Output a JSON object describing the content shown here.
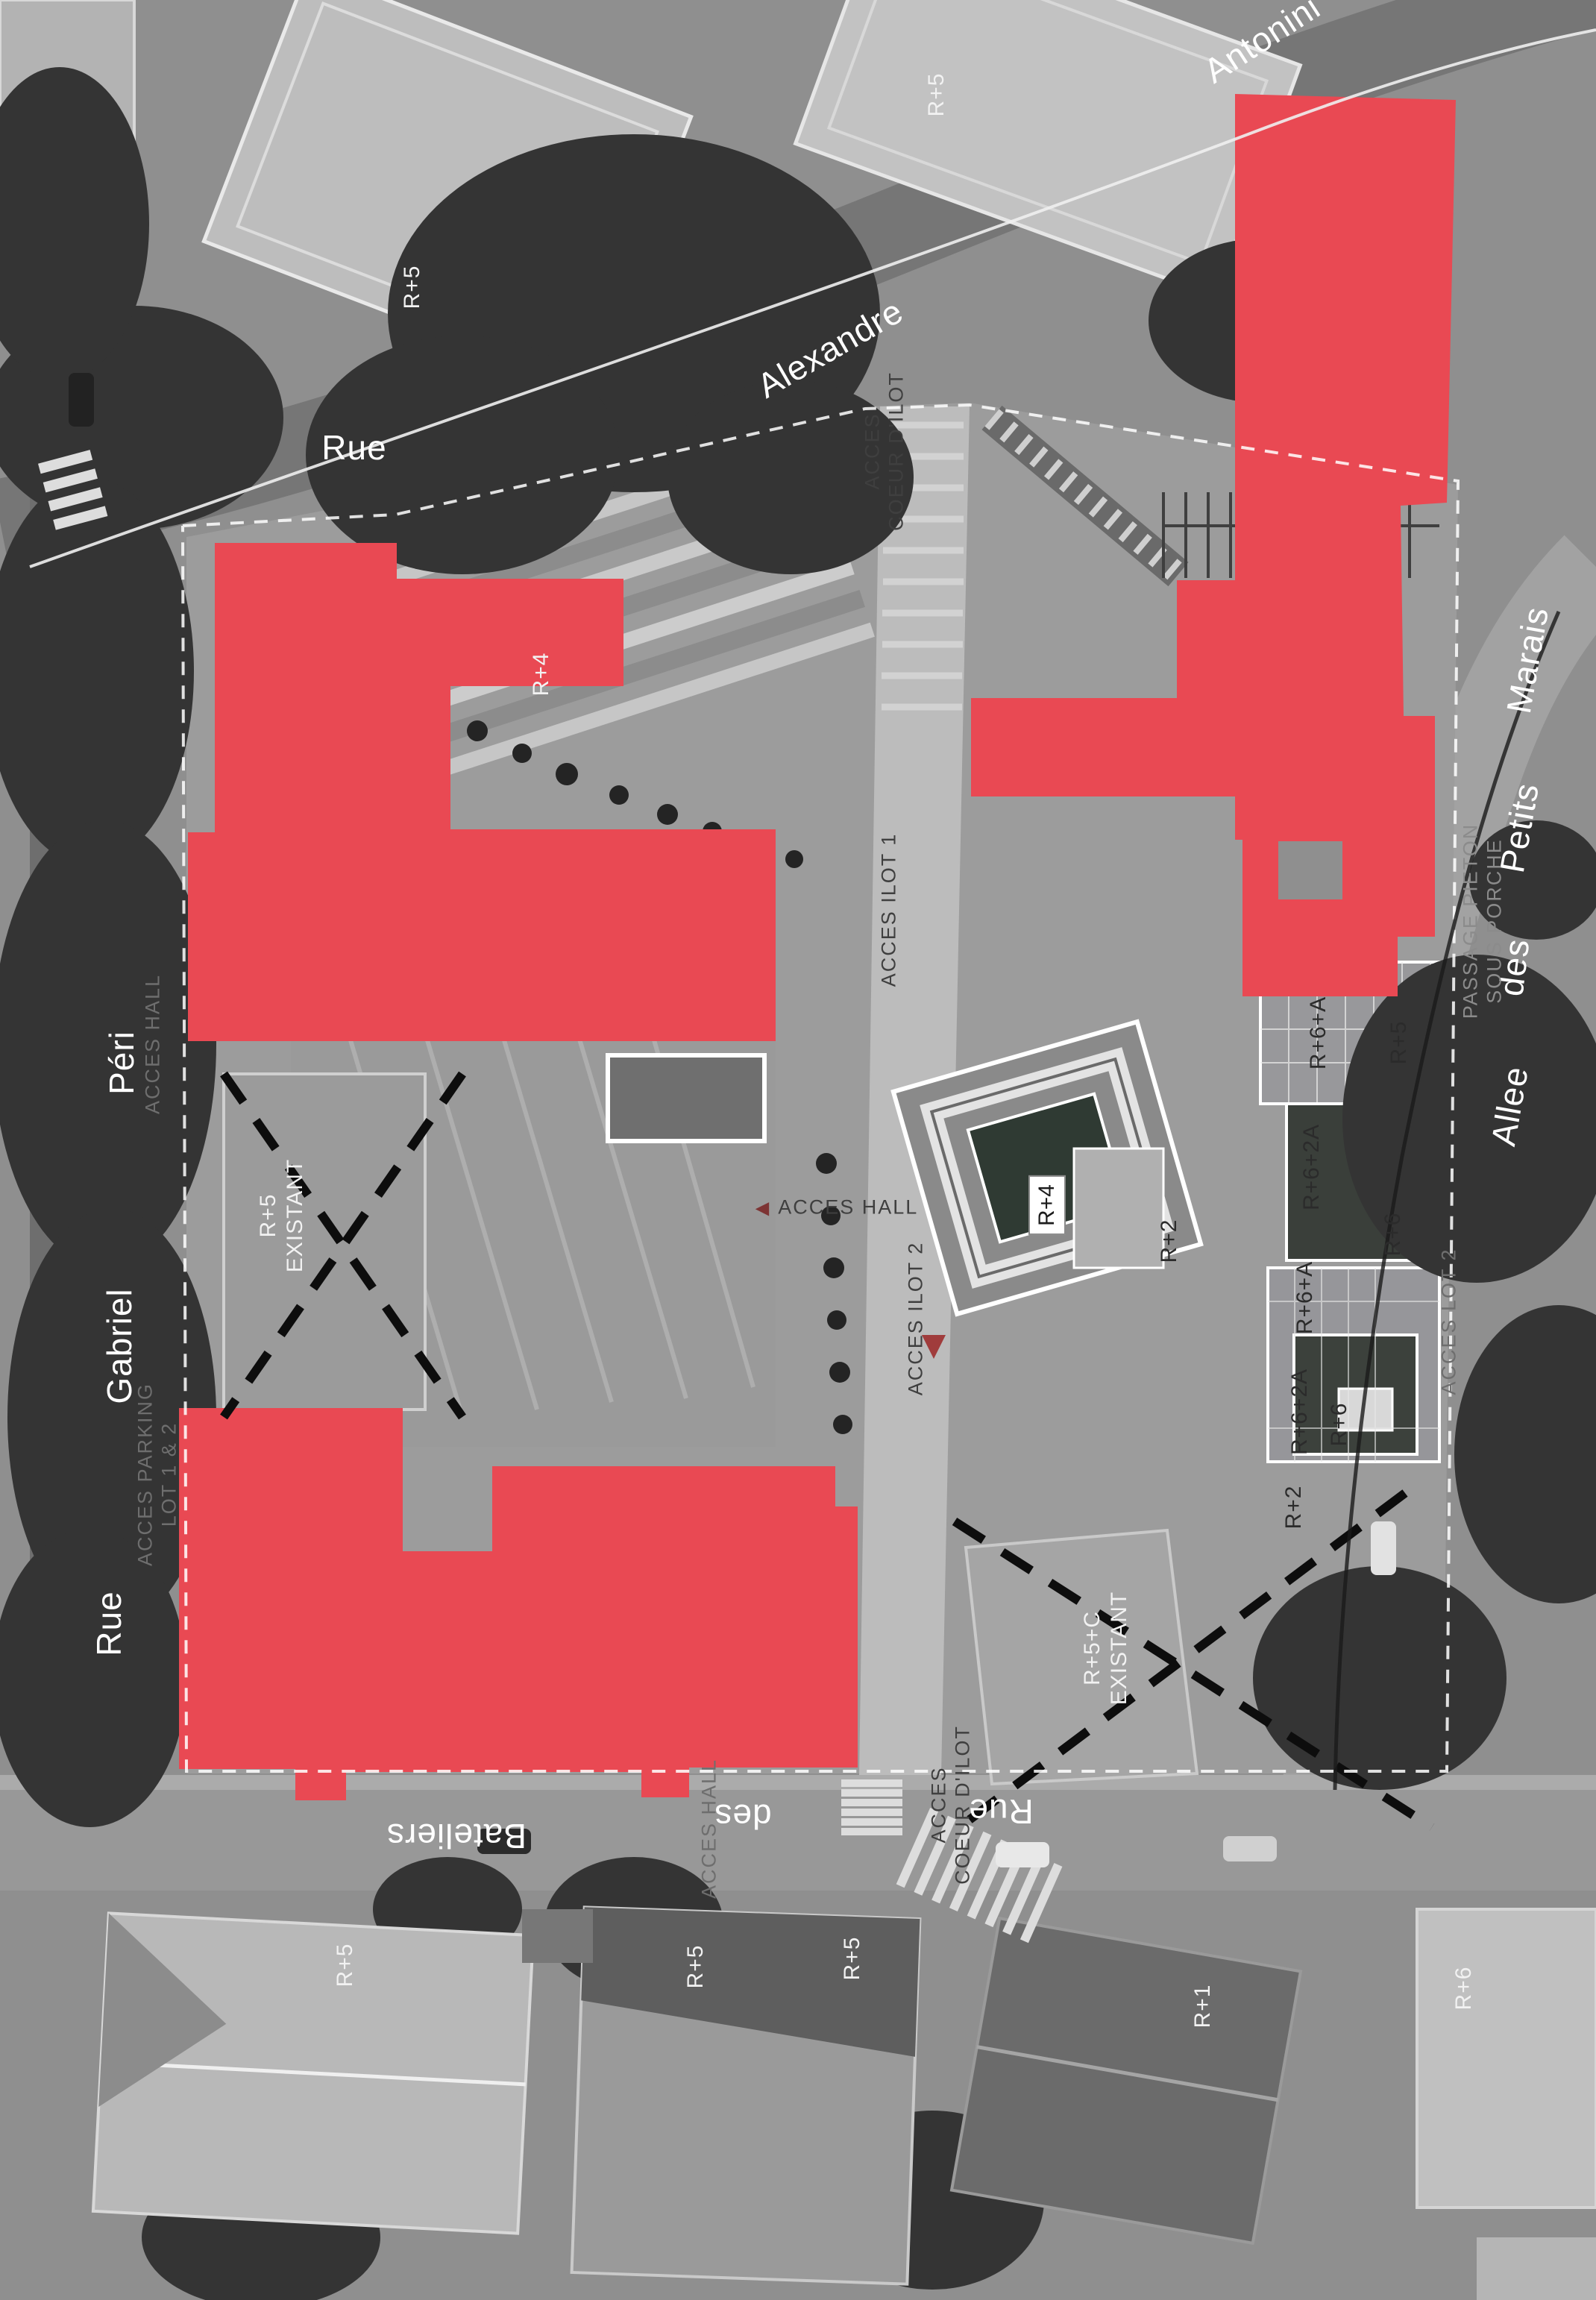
{
  "colors": {
    "highlight_red": "#E94953",
    "street_label": "#FFFFFF",
    "plan_label_dark": "#2B2B2B",
    "access_label_gray": "#4A4A4A",
    "arrow_red": "#8A3A3A"
  },
  "labels": {
    "street_rue_top": "Rue",
    "street_alexandre": "Alexandre",
    "street_antonini": "Antonini",
    "street_marais": "Marais",
    "street_petits": "Petits",
    "street_des_right": "des",
    "street_allee": "Allee",
    "street_peri": "Péri",
    "street_gabriel": "Gabriel",
    "street_rue_left": "Rue",
    "street_bateliers": "Bateliers",
    "street_des_bottom": "des",
    "street_rue_bottom": "Rue",
    "r5_topleft": "R+5",
    "r5_topcenter": "R+5",
    "r4_on_red": "R+4",
    "r5_bottom_1": "R+5",
    "r5_bottom_2": "R+5",
    "r5_bottom_3": "R+5",
    "r1_bottom": "R+1",
    "r6_bottom": "R+6",
    "existing_left_line1": "R+5",
    "existing_left_line2": "EXISTANT",
    "existing_bottom_line1": "R+5+C",
    "existing_bottom_line2": "EXISTANT",
    "r4_box": "R+4",
    "r2_upper": "R+2",
    "r2_lower": "R+2",
    "r6a_north": "R+6+A",
    "r5_east": "R+5",
    "r62a_north": "R+6+2A",
    "r6_east": "R+6",
    "r6a_south": "R+6+A",
    "r62a_south": "R+6+2A",
    "r6_south": "R+6",
    "access_hall_center": "ACCES HALL",
    "access_ilot2": "ACCES ILOT 2",
    "access_lot2": "ACCES LOT 2",
    "access_ilot1": "ACCES ILOT 1",
    "access_coeur_top_line1": "ACCES",
    "access_coeur_top_line2": "COEUR D'ILOT",
    "access_coeur_bottom_line1": "ACCES",
    "access_coeur_bottom_line2": "COEUR D'ILOT",
    "access_parking_line1": "ACCES PARKING",
    "access_parking_line2": "LOT 1 & 2",
    "access_hall_left": "ACCES HALL",
    "access_hall_bottom": "ACCES HALL",
    "passage_line1": "PASSAGE PIETON",
    "passage_line2": "SOUS PORCHE"
  }
}
